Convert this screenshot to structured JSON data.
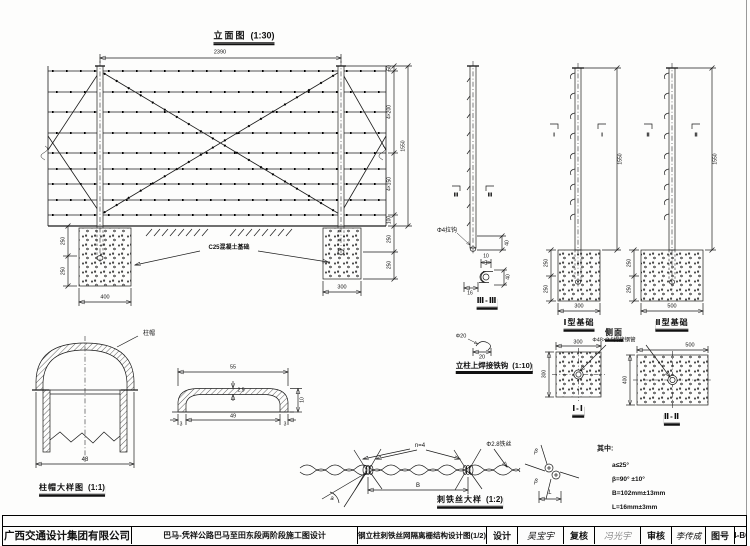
{
  "titleblock": {
    "company": "广西交通设计集团有限公司",
    "project": "巴马-凭祥公路巴马至田东段两阶段施工图设计",
    "drawing_title": "钢立柱刺铁丝网隔离栅结构设计图(1/2)",
    "design_label": "设计",
    "design_sig": "吴宝宇",
    "check_label": "复核",
    "check_sig": "冯光宇",
    "audit_label": "审核",
    "audit_sig": "李传成",
    "number_label": "图号",
    "number_value": "T-4-BG1"
  },
  "elevation": {
    "title": "立面图",
    "scale": "(1:30)",
    "footing_label": "C25混凝土基础",
    "dims": {
      "span": "2390",
      "top": "50",
      "upper": "4×200",
      "lower": "4×150",
      "bottom": "100",
      "total": "1550",
      "r_embed1": "250",
      "r_embed2": "250",
      "l_embed1": "250",
      "l_embed2": "250",
      "foot_w_left": "400",
      "foot_w_right": "300"
    }
  },
  "post_detail": {
    "section_label": "Ⅲ-Ⅲ",
    "mark": "Ⅲ",
    "hook_callout": "Φ4拉钩",
    "dims": {
      "embed": "40",
      "hook_top": "10",
      "hook_left": "16",
      "hook_right": "40"
    }
  },
  "weld_hook": {
    "title": "立柱上焊接铁钩",
    "scale": "(1:10)",
    "dims": {
      "d": "Φ20",
      "w": "20"
    }
  },
  "type1": {
    "title": "Ⅰ型基础",
    "mark": "Ⅰ",
    "dims": {
      "h": "1550",
      "e1": "250",
      "e2": "250",
      "w": "300"
    }
  },
  "type2": {
    "title": "Ⅱ型基础",
    "mark": "Ⅱ",
    "dims": {
      "h": "1550",
      "e1": "250",
      "e2": "250",
      "w": "500"
    }
  },
  "side_view": {
    "title": "侧面",
    "pipe_callout": "Φ48×3.5焊接钢管"
  },
  "section1": {
    "title": "Ⅰ-Ⅰ",
    "dims": {
      "w": "300",
      "h": "300"
    }
  },
  "section2": {
    "title": "Ⅱ-Ⅱ",
    "dims": {
      "w": "500",
      "h": "400"
    }
  },
  "cap": {
    "title": "柱帽大样图",
    "scale": "(1:1)",
    "callout": "柱帽",
    "dims": {
      "w": "48"
    }
  },
  "cap_profile": {
    "dims": {
      "outer": "55",
      "inner": "49",
      "side_l": "3",
      "side_r": "3",
      "h": "10",
      "wall": "2.5"
    }
  },
  "barbed_wire": {
    "title": "刺铁丝大样",
    "scale": "(1:2)",
    "n_callout": "n=4",
    "wire_callout": "Φ2.8铁丝",
    "dim_b": "B",
    "angle": "a",
    "beta1": "β",
    "beta2": "β",
    "dim_l": "L"
  },
  "notes": {
    "head": "其中:",
    "line1": "a≤25°",
    "line2": "β=90° ±10°",
    "line3": "B=102mm±13mm",
    "line4": "L=16mm±3mm"
  }
}
